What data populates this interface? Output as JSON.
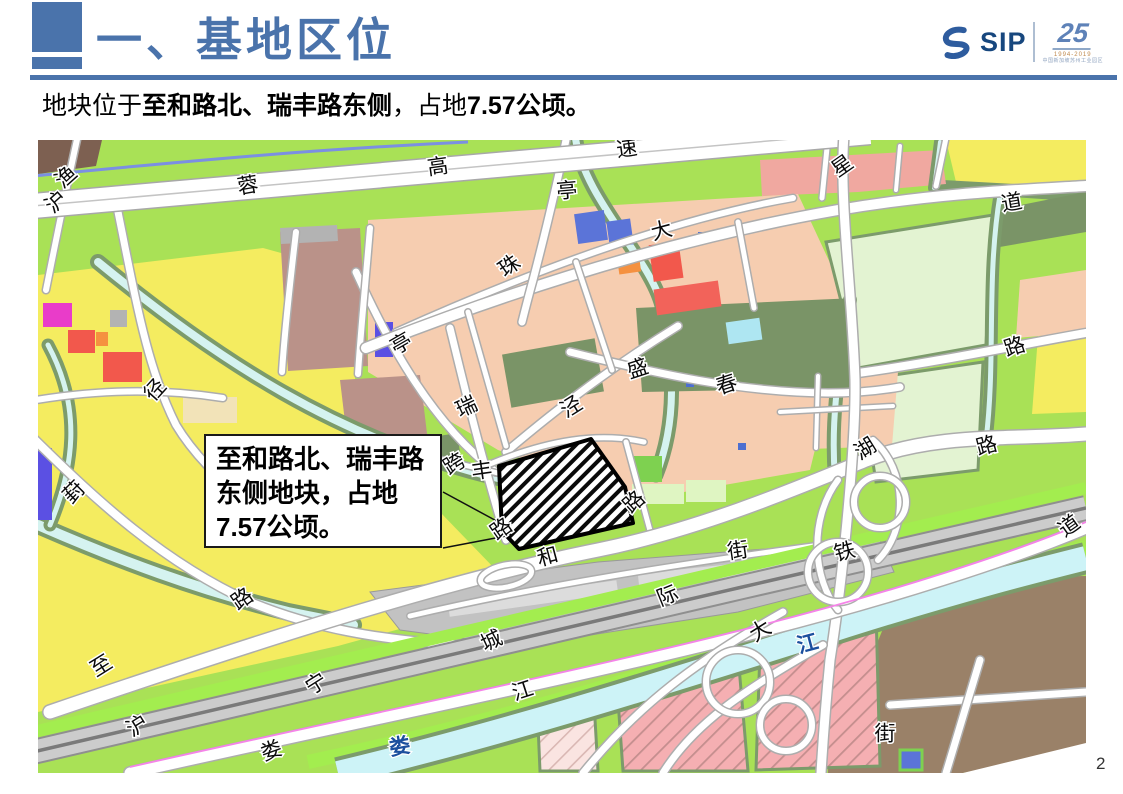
{
  "header": {
    "title": "一、基地区位",
    "accent_color": "#4A73AB"
  },
  "logo": {
    "sip": "SIP",
    "anniversary": "25",
    "years": "1994-2019",
    "tagline": "中国新加坡苏州工业园区"
  },
  "subtitle": {
    "pre": "地块位于",
    "bold1": "至和路北、瑞丰路东侧",
    "mid": "，占地",
    "bold2": "7.57公顷。"
  },
  "map": {
    "callout": {
      "line1": "至和路北、瑞丰路",
      "line2": "东侧地块，占地",
      "line3": "7.57公顷。"
    },
    "site_area_hectares": "7.57",
    "map_colors": {
      "residential_salmon": "#F6CDB0",
      "farmland_yellow": "#F4EC60",
      "greenland": "#A9E156",
      "pale_green": "#E3F3D2",
      "water_cyan": "#CDF3F7",
      "industrial_mauve": "#BA9289",
      "commercial_red": "#F2584C",
      "institution_blue": "#5B74D8",
      "village_brown": "#9A8168",
      "railway_grey": "#CCCCCC",
      "planned_pink": "#F5AFB2"
    },
    "labels": [
      {
        "t": "渔",
        "x": 29,
        "y": 38,
        "r": -42
      },
      {
        "t": "沪",
        "x": 19,
        "y": 63,
        "r": -42
      },
      {
        "t": "蓉",
        "x": 210,
        "y": 47,
        "r": -10
      },
      {
        "t": "高",
        "x": 400,
        "y": 28,
        "r": -8
      },
      {
        "t": "速",
        "x": 589,
        "y": 10,
        "r": -8
      },
      {
        "t": "亭",
        "x": 529,
        "y": 52,
        "r": -5
      },
      {
        "t": "星",
        "x": 805,
        "y": 27,
        "r": -35
      },
      {
        "t": "道",
        "x": 974,
        "y": 64,
        "r": -10
      },
      {
        "t": "珠",
        "x": 472,
        "y": 127,
        "r": -35
      },
      {
        "t": "大",
        "x": 624,
        "y": 92,
        "r": -15
      },
      {
        "t": "亭",
        "x": 364,
        "y": 205,
        "r": -30
      },
      {
        "t": "径",
        "x": 118,
        "y": 251,
        "r": -48
      },
      {
        "t": "葑",
        "x": 37,
        "y": 353,
        "r": -45
      },
      {
        "t": "路",
        "x": 205,
        "y": 460,
        "r": -35
      },
      {
        "t": "瑞",
        "x": 429,
        "y": 268,
        "r": -25
      },
      {
        "t": "泾",
        "x": 534,
        "y": 268,
        "r": -32
      },
      {
        "t": "盛",
        "x": 600,
        "y": 230,
        "r": -18
      },
      {
        "t": "春",
        "x": 689,
        "y": 246,
        "r": -18
      },
      {
        "t": "湖",
        "x": 828,
        "y": 310,
        "r": -32
      },
      {
        "t": "路",
        "x": 949,
        "y": 307,
        "r": -15
      },
      {
        "t": "路",
        "x": 977,
        "y": 208,
        "r": -18
      },
      {
        "t": "跨",
        "x": 417,
        "y": 325,
        "r": -32
      },
      {
        "t": "丰",
        "x": 444,
        "y": 332,
        "r": -8
      },
      {
        "t": "路",
        "x": 464,
        "y": 390,
        "r": -35
      },
      {
        "t": "路",
        "x": 597,
        "y": 363,
        "r": -42
      },
      {
        "t": "和",
        "x": 510,
        "y": 418,
        "r": -15
      },
      {
        "t": "街",
        "x": 700,
        "y": 412,
        "r": -8
      },
      {
        "t": "际",
        "x": 630,
        "y": 457,
        "r": -22
      },
      {
        "t": "城",
        "x": 454,
        "y": 502,
        "r": -25
      },
      {
        "t": "铁",
        "x": 807,
        "y": 413,
        "r": -15
      },
      {
        "t": "道",
        "x": 1032,
        "y": 387,
        "r": -35
      },
      {
        "t": "大",
        "x": 723,
        "y": 492,
        "r": -32
      },
      {
        "t": "江",
        "x": 485,
        "y": 552,
        "r": -18
      },
      {
        "t": "至",
        "x": 64,
        "y": 527,
        "r": -32
      },
      {
        "t": "沪",
        "x": 100,
        "y": 587,
        "r": -32
      },
      {
        "t": "宁",
        "x": 279,
        "y": 545,
        "r": -32
      },
      {
        "t": "娄",
        "x": 234,
        "y": 612,
        "r": -20
      },
      {
        "t": "娄",
        "x": 362,
        "y": 608,
        "r": -10,
        "c": "water"
      },
      {
        "t": "江",
        "x": 770,
        "y": 505,
        "r": -15,
        "c": "water"
      },
      {
        "t": "街",
        "x": 847,
        "y": 595,
        "r": 0
      }
    ]
  },
  "slide": {
    "page_number": "2"
  }
}
